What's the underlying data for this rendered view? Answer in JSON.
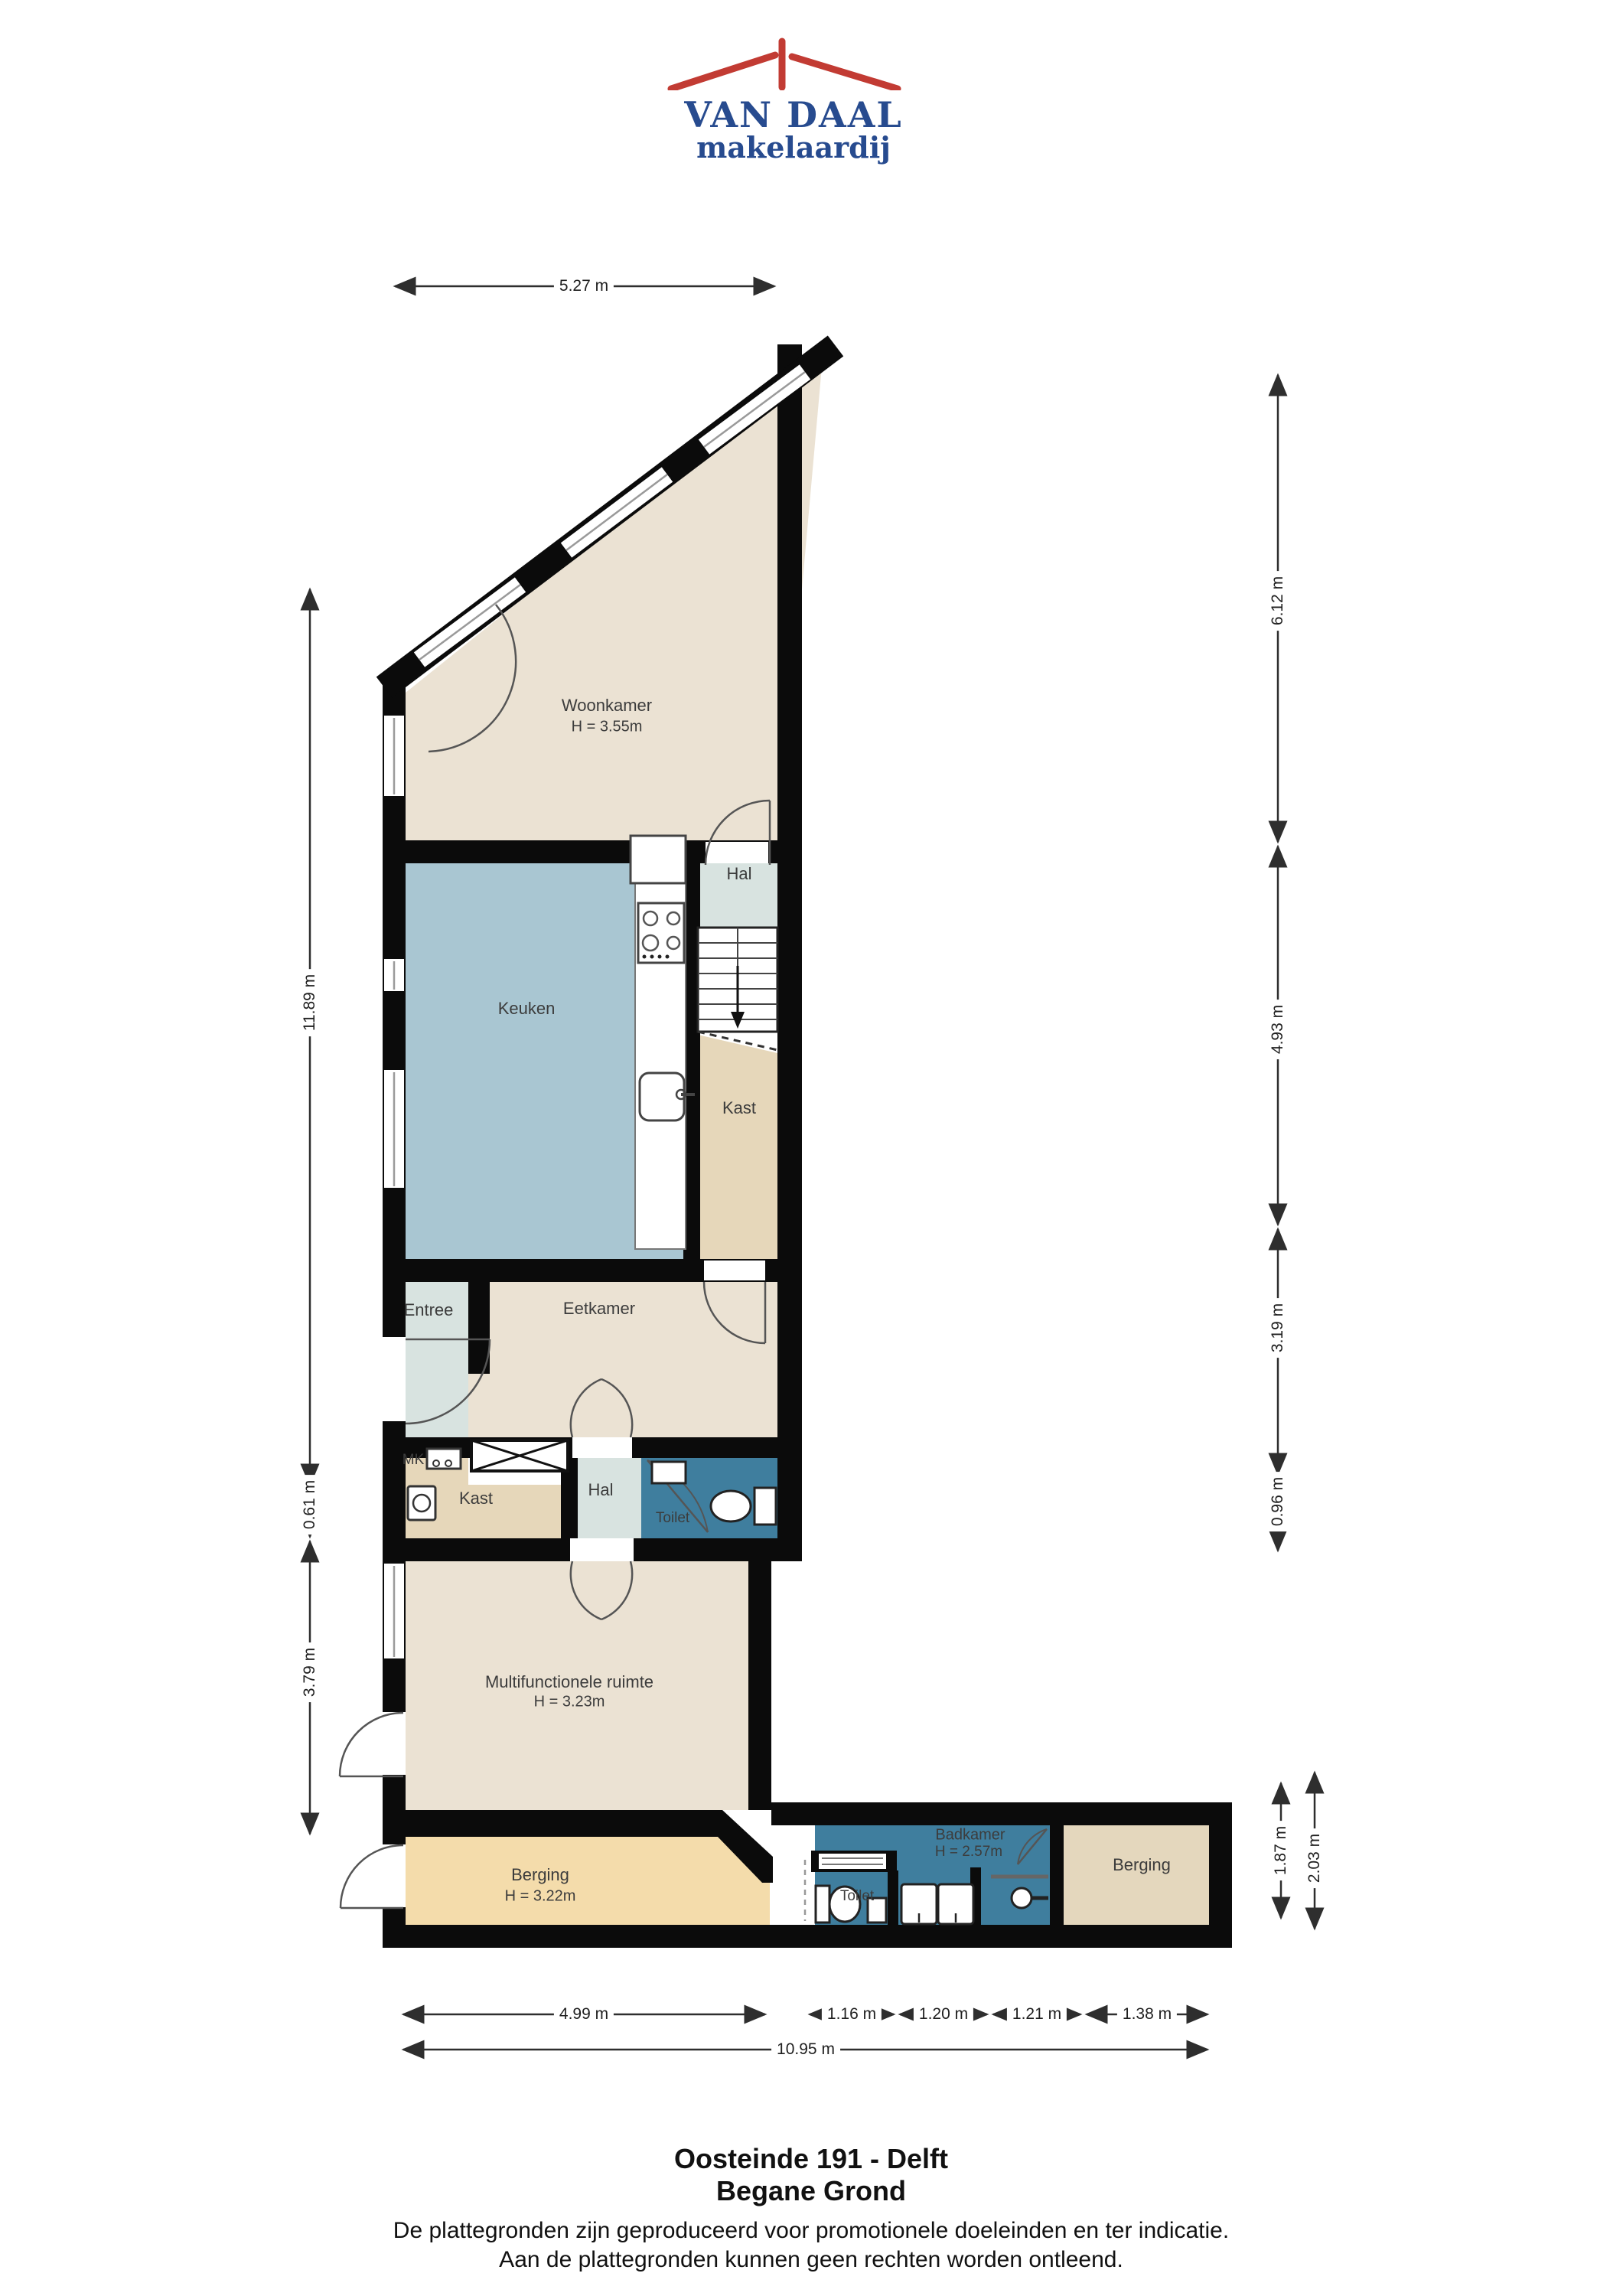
{
  "logo": {
    "title": "VAN DAAL",
    "subtitle": "makelaardij",
    "brand_blue": "#274b8f",
    "brand_red": "#c23b33",
    "roof_icon": "red-roof-with-chimney"
  },
  "rooms": {
    "woonkamer": {
      "label": "Woonkamer",
      "height": "H = 3.55m"
    },
    "keuken": {
      "label": "Keuken"
    },
    "hal_top": {
      "label": "Hal"
    },
    "kast_top": {
      "label": "Kast"
    },
    "entree": {
      "label": "Entree"
    },
    "eetkamer": {
      "label": "Eetkamer"
    },
    "mk": {
      "label": "MK"
    },
    "kast_mid": {
      "label": "Kast"
    },
    "hal_mid": {
      "label": "Hal"
    },
    "toilet_mid": {
      "label": "Toilet"
    },
    "multifunctioneel": {
      "label": "Multifunctionele ruimte",
      "height": "H = 3.23m"
    },
    "berging_left": {
      "label": "Berging",
      "height": "H = 3.22m"
    },
    "toilet_bottom": {
      "label": "Toilet"
    },
    "badkamer": {
      "label": "Badkamer",
      "height": "H = 2.57m"
    },
    "berging_right": {
      "label": "Berging"
    }
  },
  "dims": {
    "top": "5.27 m",
    "left": [
      "11.89 m",
      "0.61 m",
      "3.79 m"
    ],
    "right": [
      "6.12 m",
      "4.93 m",
      "3.19 m",
      "0.96 m",
      "1.87 m",
      "2.03 m"
    ],
    "bottom_segments": [
      "4.99 m",
      "1.16 m",
      "1.20 m",
      "1.21 m",
      "1.38 m"
    ],
    "bottom_total": "10.95 m"
  },
  "footer": {
    "address": "Oosteinde 191 - Delft",
    "floor": "Begane Grond",
    "disclaimer1": "De plattegronden zijn geproduceerd voor promotionele doeleinden en ter indicatie.",
    "disclaimer2": "Aan de plattegronden kunnen geen rechten worden ontleend."
  },
  "colors": {
    "wall": "#0b0b0b",
    "living_beige": "#ebe2d3",
    "kitchen_blue": "#a9c6d2",
    "hall_pale": "#d8e3e0",
    "closet_tan": "#e6d7ba",
    "sanitary_blue": "#3f7e9e",
    "storage_orange": "#f4dcab",
    "storage_tan": "#e4d7bd",
    "dimension_line": "#2e2e2e"
  }
}
